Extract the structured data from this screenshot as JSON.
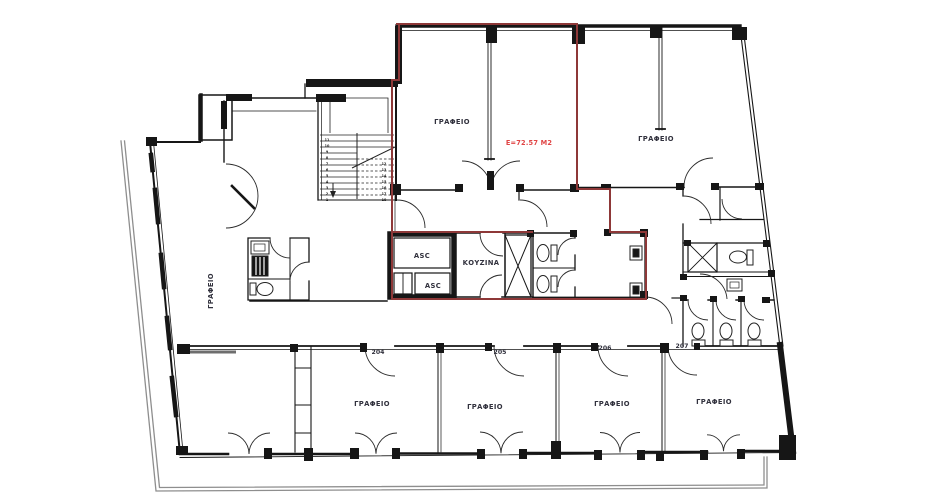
{
  "colors": {
    "wall": "#161616",
    "unit_outline": "#8e3838",
    "area_text": "#e04545",
    "boundary": "#8e8e8e",
    "low_wall": "#6e6e6e"
  },
  "unit": {
    "area_label": "E=72.57 M2"
  },
  "rooms": {
    "top_center_office": {
      "label": "ΓΡΑΦΕΙΟ"
    },
    "top_right_office": {
      "label": "ΓΡΑΦΕΙΟ"
    },
    "left_office": {
      "label": "ΓΡΑΦΕΙΟ"
    },
    "kitchen": {
      "label": "ΚΟΥΖΙΝΑ"
    },
    "elevator_top": {
      "label": "ASC"
    },
    "elevator_bottom": {
      "label": "ASC"
    },
    "office_204": {
      "number": "204",
      "label": "ΓΡΑΦΕΙΟ"
    },
    "office_205": {
      "number": "205",
      "label": "ΓΡΑΦΕΙΟ"
    },
    "office_206": {
      "number": "206",
      "label": "ΓΡΑΦΕΙΟ"
    },
    "office_207": {
      "number": "207",
      "label": "ΓΡΑΦΕΙΟ"
    }
  },
  "stairs": {
    "steps_left": [
      "11",
      "10",
      "9",
      "8",
      "7",
      "6",
      "5",
      "4",
      "3",
      "2",
      "1"
    ],
    "steps_right": [
      "12",
      "13",
      "14",
      "15",
      "16",
      "17",
      "18"
    ]
  }
}
